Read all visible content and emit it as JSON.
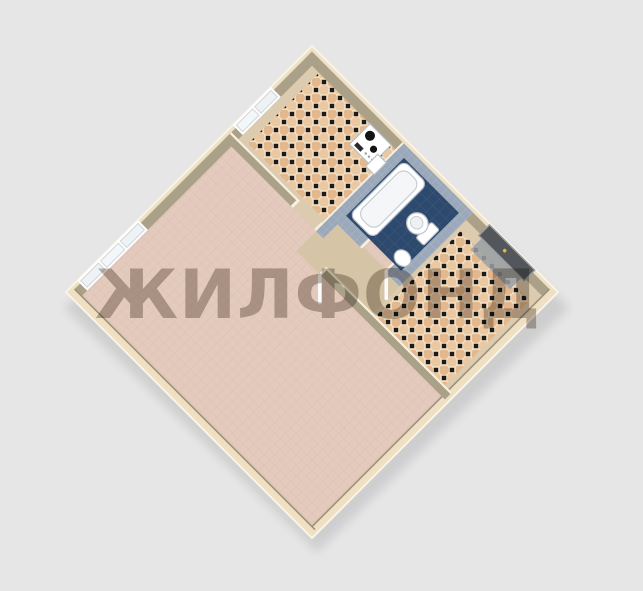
{
  "image": {
    "width": 643,
    "height": 591
  },
  "watermark": {
    "text": "ЖИЛФОНД"
  },
  "palette": {
    "background": "#e5e6e5",
    "watermarkColor": "#6e6154",
    "watermarkOpacity": "0.45",
    "wallCream": "#efe0c3",
    "wallCreamEdge": "#f8f1e0",
    "wallTan": "#aba188",
    "wallTanDark": "#9c9279",
    "kitchenBase": "#dccbaf",
    "vestibuleFloor": "#d6c4a6",
    "livingFloor": "#e3cabc",
    "livingGrid": "#d0b4a6",
    "checkerBase": "#f1debf",
    "checkerCircleA": "#e4b88e",
    "checkerCircleB": "#ecc8a2",
    "checkerDot": "#1a1a1c",
    "bathFloor": "#2d4a6e",
    "bathWall": "#9aa8ba",
    "fixtureWhite": "#ffffff",
    "fixtureLine": "#b9c0c8",
    "doorDark": "#53575b",
    "doorFrame": "#9a9da0",
    "doorHandleDot": "#d9b93e",
    "doorMat": "#9aa0a4"
  },
  "scene": {
    "type": "3d-isometric-floor-plan",
    "rooms": [
      "living-room",
      "kitchen",
      "bathroom",
      "hallway",
      "vestibule"
    ],
    "fixtures": [
      "stove",
      "kitchen-sink",
      "bathtub",
      "toilet",
      "bath-sink",
      "entrance-door",
      "door-mat",
      "kitchen-window",
      "living-room-window",
      "open-door-leaf"
    ]
  }
}
